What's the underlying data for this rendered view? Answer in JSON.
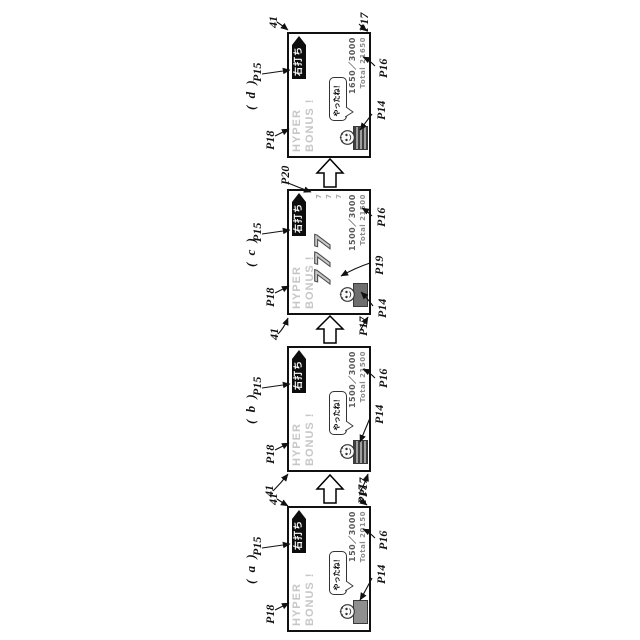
{
  "title": "Patent-style figure: pachinko display screen transition (a)-(d)",
  "colors": {
    "line": "#111111",
    "hyper_text": "#c7c7c7",
    "count_text": "#5a5a5a",
    "total_text": "#8d8d8d",
    "box_gray": "#8f8f8f",
    "strike_arrow_bg": "#0d0d0d"
  },
  "panels": [
    {
      "tag": "( a )",
      "refs": {
        "p18": "P18",
        "p15": "P15",
        "screen": "41",
        "p17": "P17",
        "p16": "P16",
        "p14": "P14"
      },
      "screen": {
        "hyper_line1": "HYPER",
        "hyper_line2": "BONUS !",
        "right_strike": "右打ち",
        "bubble": "やったね！",
        "count": "150／3000",
        "total": "Total 20150"
      }
    },
    {
      "tag": "( b )",
      "refs": {
        "p18": "P18",
        "p15": "P15",
        "screen": "41",
        "p17": "P17",
        "p16": "P16",
        "p14": "P14"
      },
      "screen": {
        "hyper_line1": "HYPER",
        "hyper_line2": "BONUS !",
        "right_strike": "右打ち",
        "bubble": "やったね！",
        "count": "1500／3000",
        "total": "Total 21500"
      }
    },
    {
      "tag": "( c )",
      "refs": {
        "p18": "P18",
        "p15": "P15",
        "screen": "41",
        "p17": "P17",
        "p16": "P16",
        "p14": "P14",
        "p19": "P19",
        "p20": "P20"
      },
      "screen": {
        "hyper_line1": "HYPER",
        "hyper_line2": "BONUS !",
        "right_strike": "右打ち",
        "big_symbols": "777",
        "mini": [
          "7",
          "7",
          "7"
        ],
        "count": "1500／3000",
        "total": "Total 21500"
      }
    },
    {
      "tag": "( d )",
      "refs": {
        "p18": "P18",
        "p15": "P15",
        "screen": "41",
        "p17": "P17",
        "p16": "P16",
        "p14": "P14"
      },
      "screen": {
        "hyper_line1": "HYPER",
        "hyper_line2": "BONUS !",
        "right_strike": "右打ち",
        "bubble": "やったね！",
        "count": "1650／3000",
        "total": "Total 21650"
      }
    }
  ]
}
